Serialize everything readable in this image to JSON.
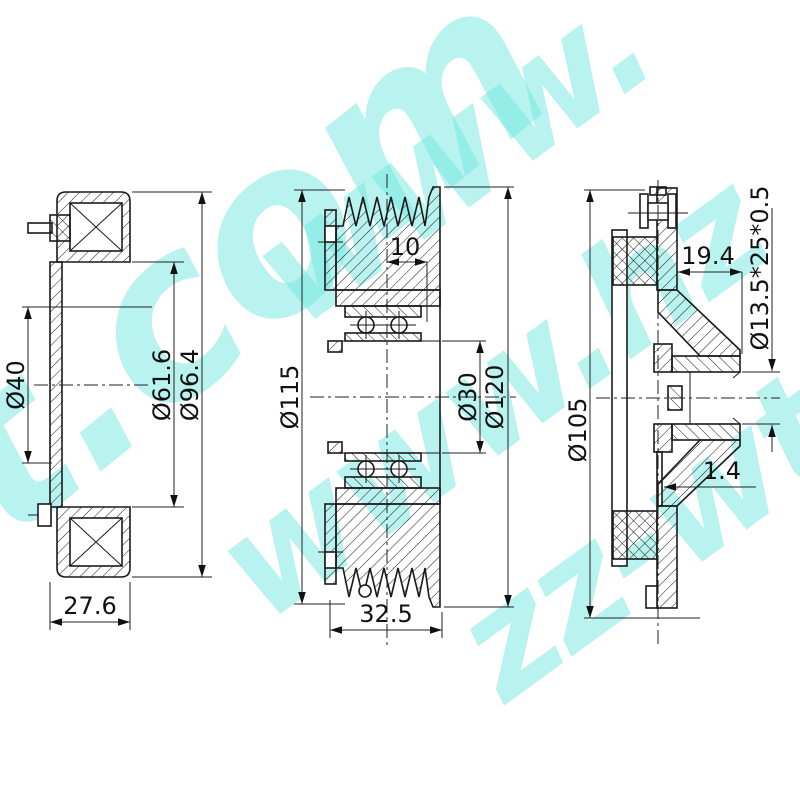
{
  "watermark": {
    "text": "www.hzz-wt.com",
    "color": "#74e9e2",
    "fragments": [
      "t.com",
      "www.",
      "www.hz",
      "zz-wt.c"
    ]
  },
  "views": {
    "coil_view": {
      "dim_bore": "Ø40",
      "dim_inner_diameter": "Ø61.6",
      "dim_outer_diameter": "Ø96.4",
      "dim_width": "27.6"
    },
    "pulley_view": {
      "dim_groove_offset": "10",
      "dim_groove_diameter": "Ø115",
      "dim_bore": "Ø30",
      "dim_outer_diameter": "Ø120",
      "dim_width": "32.5"
    },
    "hub_view": {
      "dim_outer_diameter": "Ø105",
      "dim_hub_length": "19.4",
      "dim_spline": "Ø13.5*25*0.5",
      "dim_plate_thickness": "1.4"
    }
  }
}
